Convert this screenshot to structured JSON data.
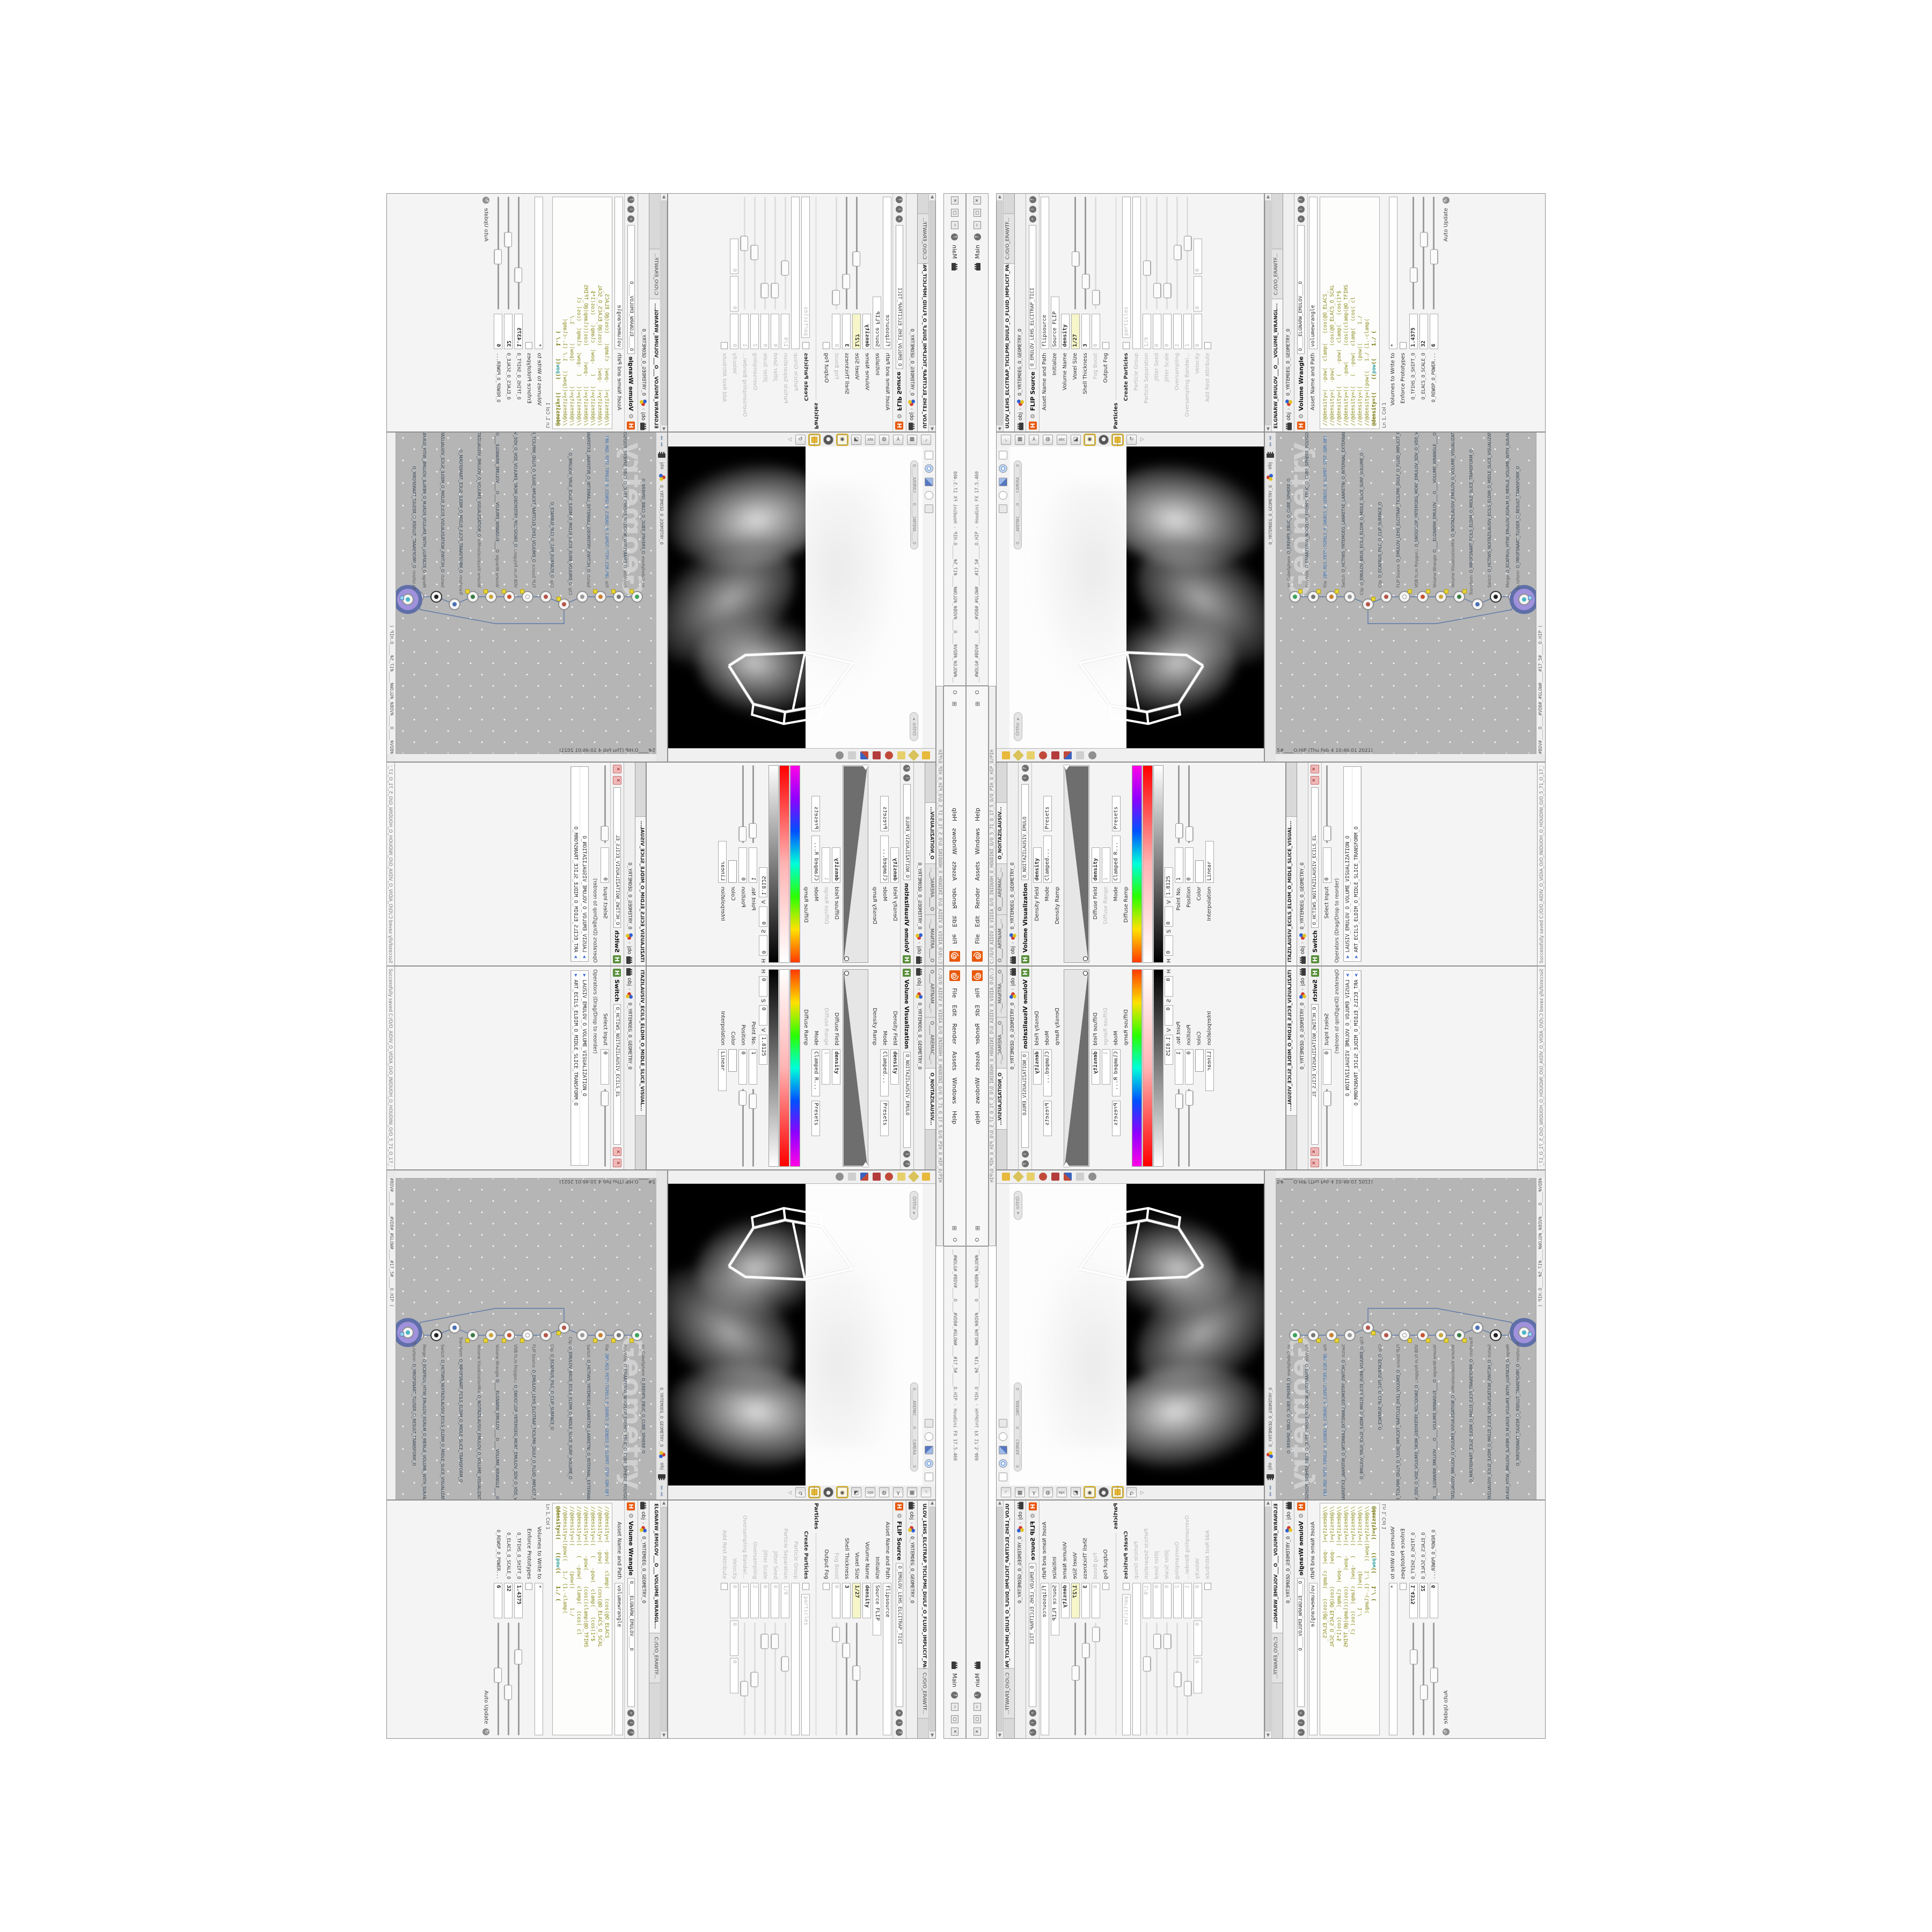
{
  "colors": {
    "logo_orange": "#e8590c",
    "yellow_field": "#f6f6c9",
    "network_bg": "#b5b5b5",
    "node_halo_purple": "#a091dc",
    "node_ring_blue": "#5f6fa8",
    "vex_olive": "#8b8b1c",
    "vex_keyword_teal": "#2e9e9e",
    "viewport_black": "#000000",
    "smoke_grey": "#c8c8c8",
    "hue_ramp": [
      "#ff3b00",
      "#ffe100",
      "#2bff00",
      "#00ffd9",
      "#0051ff",
      "#9000ff",
      "#ff00e6"
    ],
    "sat_ramp": [
      "#ffffff",
      "#ffb4b4",
      "#ff0000"
    ],
    "val_ramp": [
      "#000000",
      "#ffffff"
    ],
    "density_wedge": "#6e6e6e"
  },
  "window": {
    "title": "__#WOLG#_#BDV#____O____#VDB#_#GLOW#____#17_5#_____O.HIP - Houdini FX 17.5.460",
    "menu": [
      "File",
      "Edit",
      "Render",
      "Assets",
      "Windows",
      "Help"
    ],
    "menu_prefix_icon": "window-grid-icon",
    "menu_prefix_o": "O",
    "path_bar": "C:/O/O_AIDIV_O_VIDIA_O/O_INIDUOH_O_HOUDINI_O/O_5_71_O_17_5_O/O_PIH_O_HIP_O/PIH",
    "shelf_label": "Main",
    "help_btn": "?",
    "win_min": "─",
    "win_max": "▢",
    "win_close": "✕",
    "saved_status": "Successfully saved C:/O/O_AIDIV_O_VIDIA_O/O_INIDUOH_O_HOUDINI_O/O_5_71_O_17_5_O/O_PIH_O_HIP_O/PIH.HIP"
  },
  "flip_pane": {
    "tab": "ULOV_LEHS_ELCITRAP_TICILPMI_DIULF_O_FLUID_IMPLICIT_PARTI...",
    "crumb_root": "obj",
    "crumb_net": "O_YRTEMOEG_O_GEOMETRY_O",
    "title": "FLIP Source",
    "name": "O_EMULOV_LEHS_ELCITRAP_TICI",
    "path_tab": "C:/O/O_ERAWTF...",
    "asset_label": "Asset Name and Path",
    "asset_value": "flipsource",
    "rows": {
      "initialize_label": "Initialize",
      "initialize_value": "Source FLIP",
      "volume_name_label": "Volume Name",
      "volume_name_value": "density",
      "voxel_size_label": "Voxel Size",
      "voxel_size_value": "1/27",
      "shell_label": "Shell Thickness",
      "shell_value": "3",
      "fog_boost_label": "Fog Boost",
      "fog_boost_value": "0",
      "output_fog_label": "Output Fog",
      "particles_section": "Particles",
      "create_particles_label": "Create Particles",
      "particles_value": "particles",
      "particle_group_label": "Particle Group",
      "particle_group_value": "",
      "particle_sep_label": "Particle Separation",
      "particle_sep_value": "1/9",
      "jitter_seed_label": "Jitter Seed",
      "jitter_seed_value": "0",
      "jitter_scale_label": "Jitter Scale",
      "jitter_scale_value": "0",
      "oversampling_label": "Oversampling",
      "oversampling_value": "2",
      "oversampling_bw_label": "Oversampling Bandwi...",
      "oversampling_bw_value": "1",
      "velocity_label": "Velocity",
      "velocity_value": "0",
      "add_rest_label": "Add Rest Attribute"
    }
  },
  "wrangle_pane": {
    "tab": "ELGNARW_EMULOV___O___VOLUME_WRANGL...",
    "crumb_root": "obj",
    "crumb_net": "O_YRTEMOEG_O_GEOMETRY_O",
    "title": "Volume Wrangle",
    "name": "O____ELGNARW_EMULOV____O",
    "path_tab": "C:/O/O_ERAWTF...",
    "asset_label": "Asset Name and Path",
    "asset_value": "volumewrangle",
    "code_lines": [
      "//@density=(  -pow(  clamp(   (cos(@O_ELACS_",
      "//@density=(  -pow(       (cos(@O_ELACS_O_SCAL",
      "//@density=((   (   -pow(  clamp(   (cos(1*$",
      "//@density=((   -pow(     (cos((clamp(@O_TFIHS",
      "//@density=((   (  -pow(  clamp(  (cos( cl",
      "//@density=((        (pow((      1./",
      "//@density=((pow((   1./ (1.-clamp("
    ],
    "active_line_pre": "@density=((    ((",
    "active_line_kw": "pow",
    "active_line_post": "((    1./ (",
    "cursor_status": "Ln 1, Col 1",
    "volumes_label": "Volumes to Write to",
    "volumes_value": "*",
    "enforce_label": "Enforce Prototypes",
    "sliders": [
      {
        "label": "O_TFIHS_O_SHIFT_O",
        "value": "1.4375"
      },
      {
        "label": "O_ELACS_O_SCALE_O",
        "value": "32"
      },
      {
        "label": "O_REWOP_O_POWER...",
        "value": "6"
      }
    ],
    "auto_update": "Auto Update"
  },
  "viewport": {
    "camera_pill": "O____AREMAC____O____CAMERA____O",
    "view_pill": "Ortho ▾",
    "toolbar_icons": [
      "ease-curve-icon",
      "corner-pin-icon",
      "tripod-icon",
      "uv-sphere-icon",
      "abc-label-icon",
      "snapshot-icon",
      "render-eye-icon",
      "dark-sphere-icon",
      "quad-view-icon",
      "orbit-icon"
    ],
    "side_icons": [
      "select-box-icon",
      "orbit-rings-icon",
      "view-cube-icon",
      "target-icon",
      "pin-icon"
    ],
    "bottom_icons": [
      "gold-pin-icon",
      "gold-diamond-icon",
      "yellow-folder-icon",
      "red-gears-icon",
      "red-camera-icon",
      "flag-icon",
      "clipboard-icon",
      "grey-sphere-icon"
    ]
  },
  "network": {
    "tab_root": "obj",
    "tab_net": "O_YRTEMOEG_O_GEOMETRY_O",
    "watermark": "Geometry",
    "status": "5#____O.HIP (Thu Feb 4 10:46:01 2021)",
    "title_edge": "#BDV#____O____#VDB#_#GLOW#____#17_5#____O.HIP (",
    "nodes": [
      {
        "type": "ao_CubeSphere",
        "name": "O_EREHPS_EBUC_O_CUBE_SPHERE_O"
      },
      {
        "type": "PolyWire",
        "name": "O_EMARFERIW_NOGYLOP_EREHPS_EBUC_O_CUBE_SPHERE_POLYGON_WIREFRAME_O"
      },
      {
        "type": "File",
        "name": "JBO.M23.PETS:TGPOLS_O_5OURC5_O_GENUS5_O.SLDPRT.STEP.SDM.OBJ"
      },
      {
        "type": "Switch",
        "name": "O_HCTIWS_YRTEMOEG_LANRETXE_LANRETNI_O_INTERNAL_EXTERNAL_GEOMETRY_SWITCH_O"
      },
      {
        "type": "Clip",
        "name": "O_EMULOV_BRUS_ECILS_ELDIM_O_MIDLE_SLICE_SURF_VOLUME_O"
      },
      {
        "type": "Clip",
        "name": "O_ECAFRUS_PILC_O_CLIP_SURFACE_O"
      },
      {
        "type": "FLIP Source",
        "name": "O_EMULOV_LEHS_ELCITRAP_TICILPMI_DIULF_O_FLUID_IMPLICIT_PARTICLE_SHEL_VOLUME_O"
      },
      {
        "type": "VDB from Polygons",
        "name": "O_SNOGYLOP_YRTEMOEG_MORF_EMULOV_BDV_O_VDB_VOLUME_FROM_GEOMETRY_POLYGONS_O"
      },
      {
        "type": "Volume Wrangle",
        "name": "O____ELGNARW_EMULOV____O____VOLUME_WRANGLE____O"
      },
      {
        "type": "Volume VisualizationMix",
        "name": "O_NOITAZILAUSIV_EMULOV_O_VOLUME_VISUALIZATION_O"
      },
      {
        "type": "Transform",
        "name": "O_MROFSNART_ECILS_ELDIM_O_MIDLE_SLICE_TRANSFORM_O"
      },
      {
        "type": "Switch",
        "name": "O_HCTIWS_NOITAZILAUSIV_ECILS_ELDIM_O_MIDLE_SLICE_VISUALIZATION_SWITCH_O"
      },
      {
        "type": "Merge",
        "name": "O_ECAFRUS_HTIW_EMULOV_EGREM_O_MERGE_VOLUME_WITH_SURFACE_O"
      },
      {
        "type": "Transform",
        "name": "O_MROFSNART_TLUSER_O_RESULT_TRANSFORM_O"
      }
    ]
  },
  "volviz_pane": {
    "tabs": [
      "O____ARTNAM__...",
      "O____AREMAC__...",
      "O_NOITAZILAUSIV..."
    ],
    "crumb_root": "obj",
    "crumb_net": "O_YRTEMOEG_O_GEOMETRY_O",
    "title": "Volume Visualization",
    "name": "O_NOITAZILAUSIV_EMULO",
    "density_field_label": "Density Field",
    "density_field_value": "density",
    "mode_label": "Mode",
    "density_mode_value": "Clamped...",
    "presets_label": "Presets",
    "density_ramp_label": "Density Ramp",
    "diffuse_field_label": "Diffuse Field",
    "diffuse_field_value": "density",
    "diffuse_range_label": "Diffuse Range",
    "diffuse_range_value": "1",
    "diffuse_mode_value": "Clamped R...",
    "diffuse_ramp_label": "Diffuse Ramp",
    "point_no_label": "Point No.",
    "point_no_value": "1",
    "position_label": "Position",
    "position_value": "0",
    "color_label": "Color",
    "h_label": "H",
    "h_value": "0",
    "s_label": "S",
    "s_value": "0",
    "v_label": "V",
    "v_value": "1.8125",
    "interp_label": "Interpolation",
    "interp_value": "Linear"
  },
  "switch_pane": {
    "tab": "ITAZILAUSIV_ECILS_ELDIM_O_MIDLE_SLICE_VISUAL...",
    "crumb_root": "obj",
    "crumb_net": "O_YRTEMOEG_O_GEOMETRY_O",
    "title": "Switch",
    "name": "O_HCTIWS_NOITAZILAUSIV_ECILS_EL",
    "select_input_label": "Select Input",
    "select_input_value": "0",
    "operators_label": "Operators (Drag/Drop to reorder)",
    "operators": [
      "LAUSIV_EMULOV_O_VOLUME_VISUALIZATION_O",
      "ART_ECILS_ELDIM_O_MIDLE_SLICE_TRANSFORM_O"
    ]
  }
}
